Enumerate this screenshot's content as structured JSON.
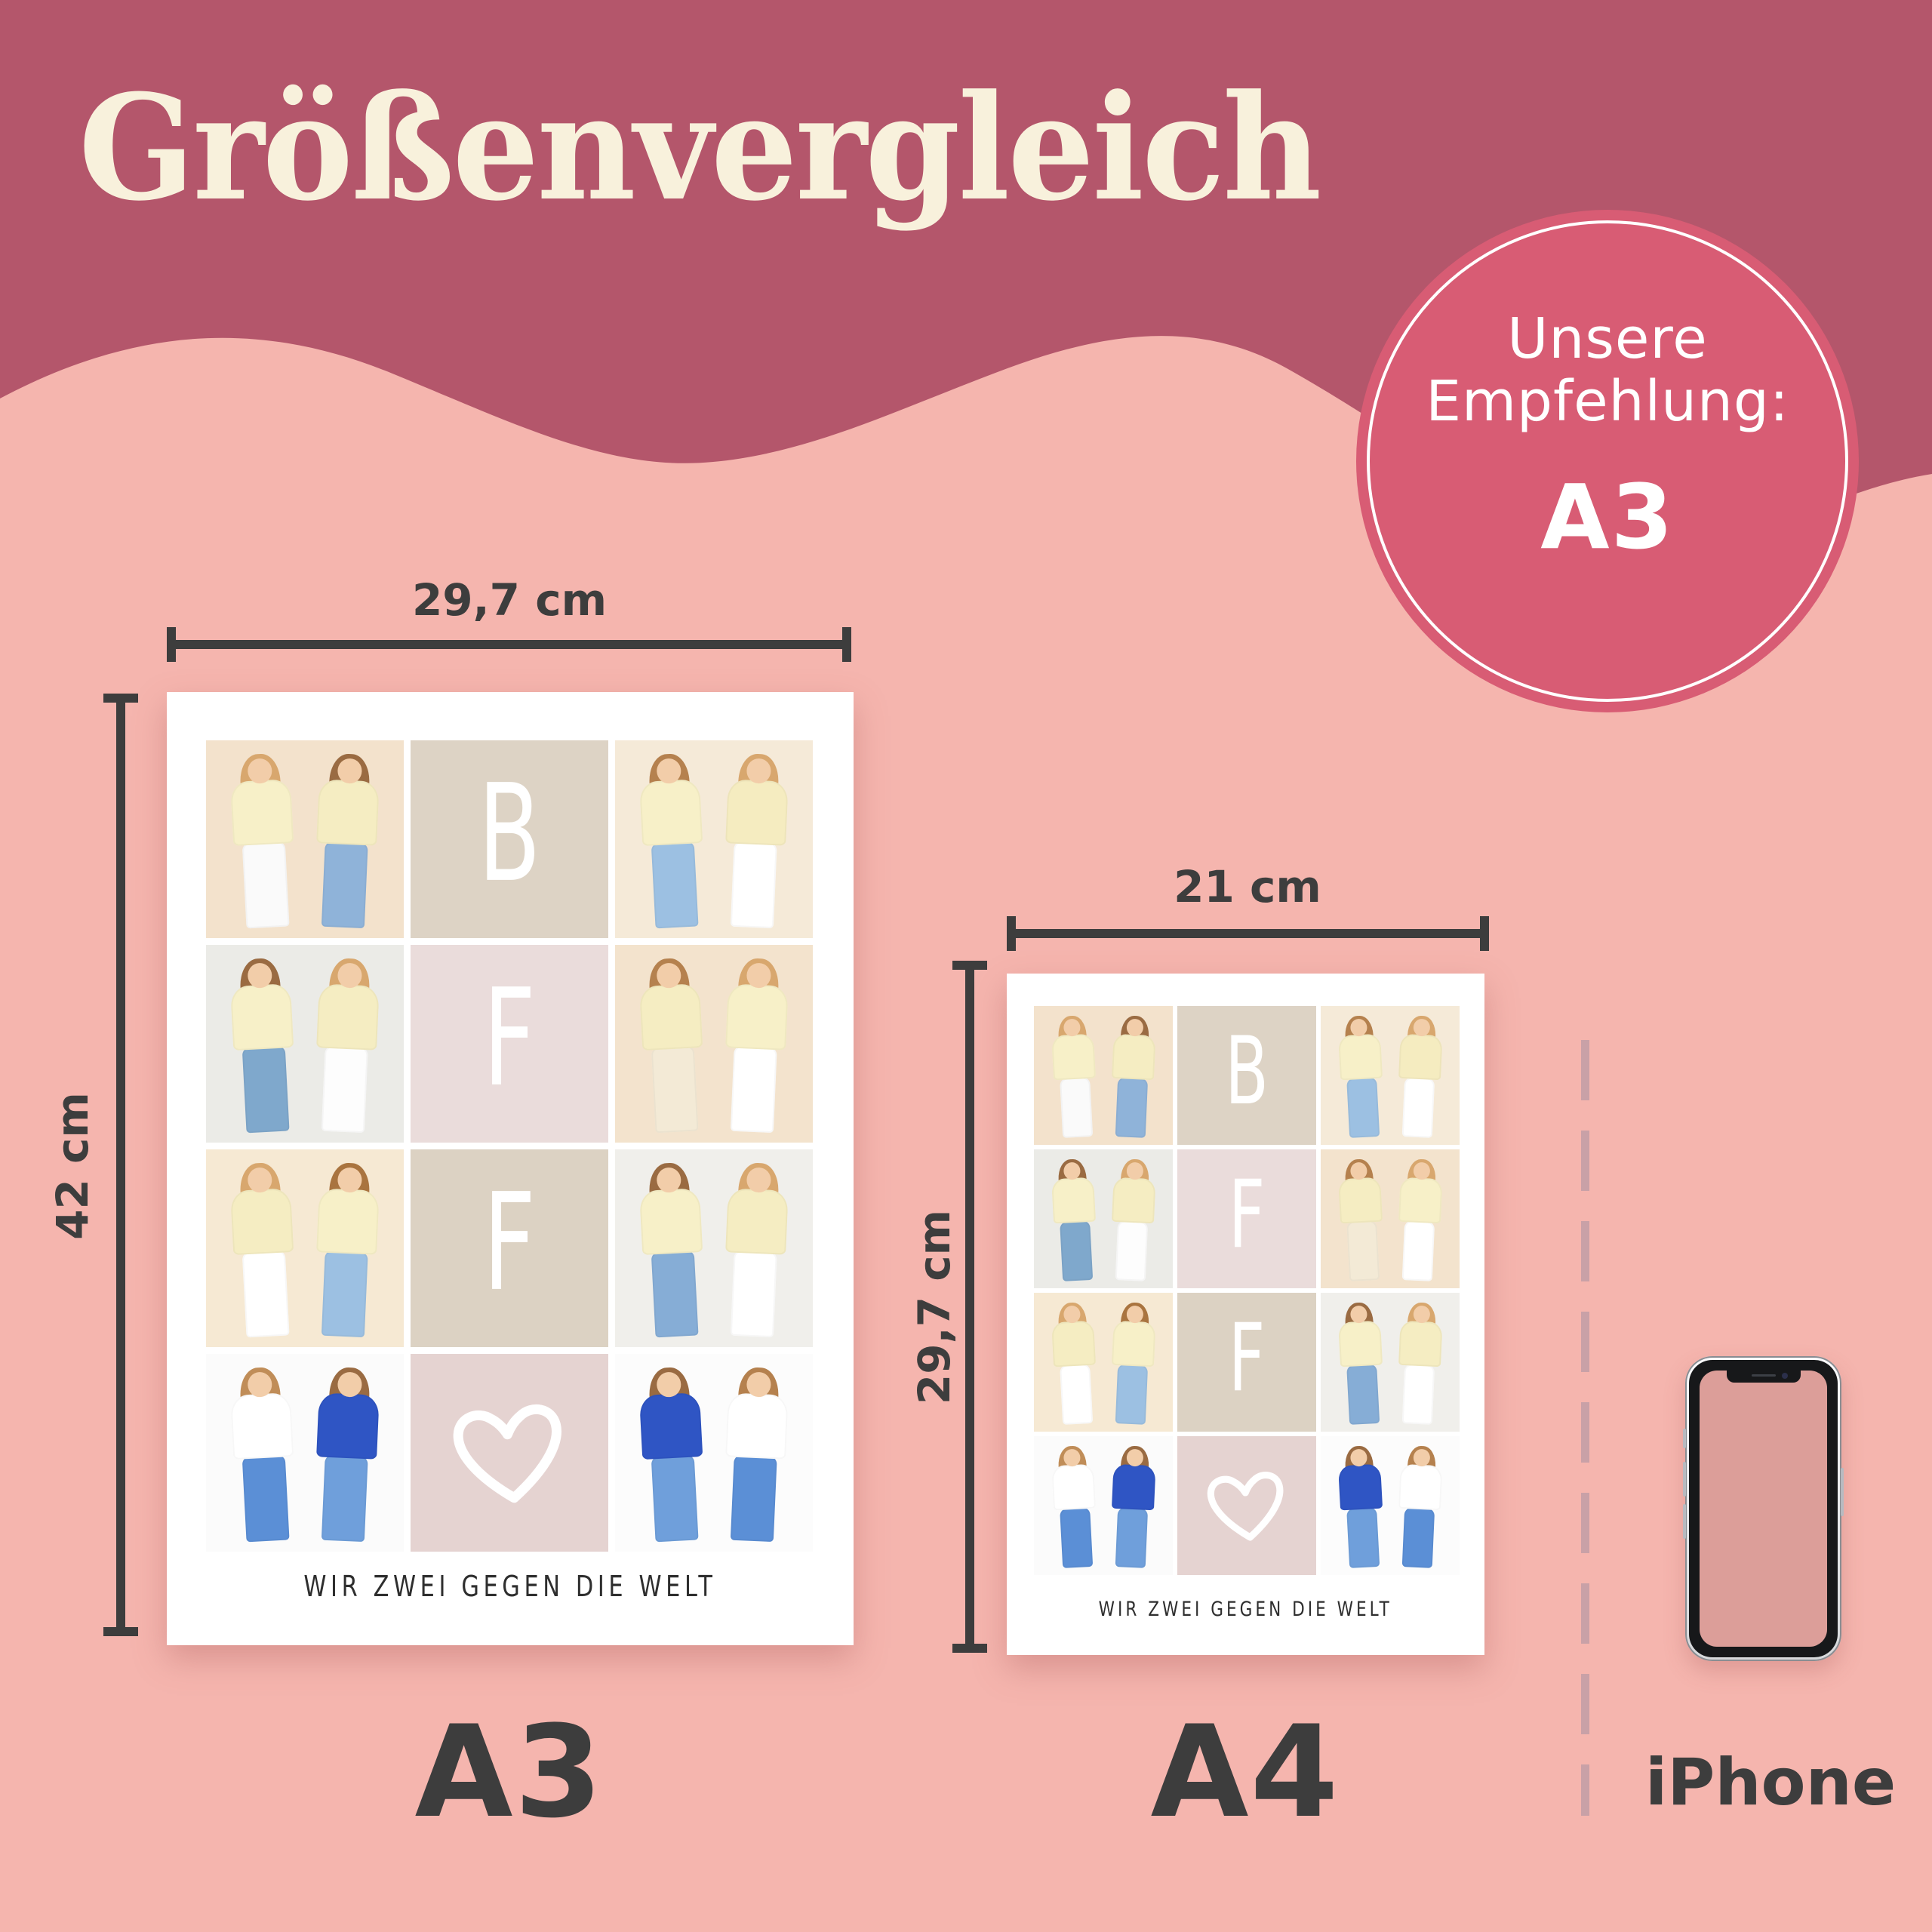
{
  "title": "Größenvergleich",
  "badge": {
    "line1": "Unsere",
    "line2": "Empfehlung:",
    "size": "A3"
  },
  "a3": {
    "label": "A3",
    "width_label": "29,7 cm",
    "height_label": "42 cm"
  },
  "a4": {
    "label": "A4",
    "width_label": "21 cm",
    "height_label": "29,7 cm"
  },
  "iphone": {
    "label": "iPhone"
  },
  "collage": {
    "caption": "WIR ZWEI GEGEN DIE WELT",
    "tiles": [
      {
        "type": "photo",
        "bg": "#f3e2cc",
        "figures": [
          {
            "hair": "#d8a76e",
            "top": "#f7f0c8",
            "pants": "#fafafa"
          },
          {
            "hair": "#9a6b42",
            "top": "#f5edc2",
            "pants": "#8fb3d9"
          }
        ]
      },
      {
        "type": "letter",
        "bg": "#ddd3c5",
        "char": "B"
      },
      {
        "type": "photo",
        "bg": "#f5ead8",
        "figures": [
          {
            "hair": "#b5814e",
            "top": "#f7f0c8",
            "pants": "#9cc0e2"
          },
          {
            "hair": "#d8a76e",
            "top": "#f5ecc0",
            "pants": "#ffffff"
          }
        ]
      },
      {
        "type": "photo",
        "bg": "#ebebe7",
        "figures": [
          {
            "hair": "#9a6b42",
            "top": "#f7f0c8",
            "pants": "#7fa8cc"
          },
          {
            "hair": "#d8a76e",
            "top": "#f5edc2",
            "pants": "#fdfdfd"
          }
        ]
      },
      {
        "type": "letter",
        "bg": "#eadcdb",
        "char": "F"
      },
      {
        "type": "photo",
        "bg": "#f3e3cd",
        "figures": [
          {
            "hair": "#b5814e",
            "top": "#f5edc2",
            "pants": "#f3ead6"
          },
          {
            "hair": "#d8a76e",
            "top": "#f7f0c8",
            "pants": "#ffffff"
          }
        ]
      },
      {
        "type": "photo",
        "bg": "#f6e9d3",
        "figures": [
          {
            "hair": "#d8a76e",
            "top": "#f5edc2",
            "pants": "#ffffff"
          },
          {
            "hair": "#a9743f",
            "top": "#f7f0c8",
            "pants": "#9cc0e2"
          }
        ]
      },
      {
        "type": "letter",
        "bg": "#dcd2c3",
        "char": "F"
      },
      {
        "type": "photo",
        "bg": "#f0efeb",
        "figures": [
          {
            "hair": "#9a6b42",
            "top": "#f7f0c8",
            "pants": "#86add6"
          },
          {
            "hair": "#d8a76e",
            "top": "#f5edc2",
            "pants": "#ffffff"
          }
        ]
      },
      {
        "type": "photo",
        "bg": "#fbfbfb",
        "figures": [
          {
            "hair": "#c08d58",
            "top": "#ffffff",
            "pants": "#5b8fd6"
          },
          {
            "hair": "#9a6b42",
            "top": "#2f55c4",
            "pants": "#6f9fdb"
          }
        ]
      },
      {
        "type": "heart",
        "bg": "#e5d3d1"
      },
      {
        "type": "photo",
        "bg": "#fcfcfc",
        "figures": [
          {
            "hair": "#9a6b42",
            "top": "#2f55c4",
            "pants": "#6f9fdb"
          },
          {
            "hair": "#b5814e",
            "top": "#ffffff",
            "pants": "#5b8fd6"
          }
        ]
      }
    ]
  },
  "colors": {
    "background": "#f5b5ae",
    "wave": "#b4566b",
    "badge": "#d85c74",
    "ink": "#3d3d3d",
    "title_text": "#f8f1dc",
    "dash": "#c9a1a7",
    "phone_screen": "#dc9e99"
  }
}
